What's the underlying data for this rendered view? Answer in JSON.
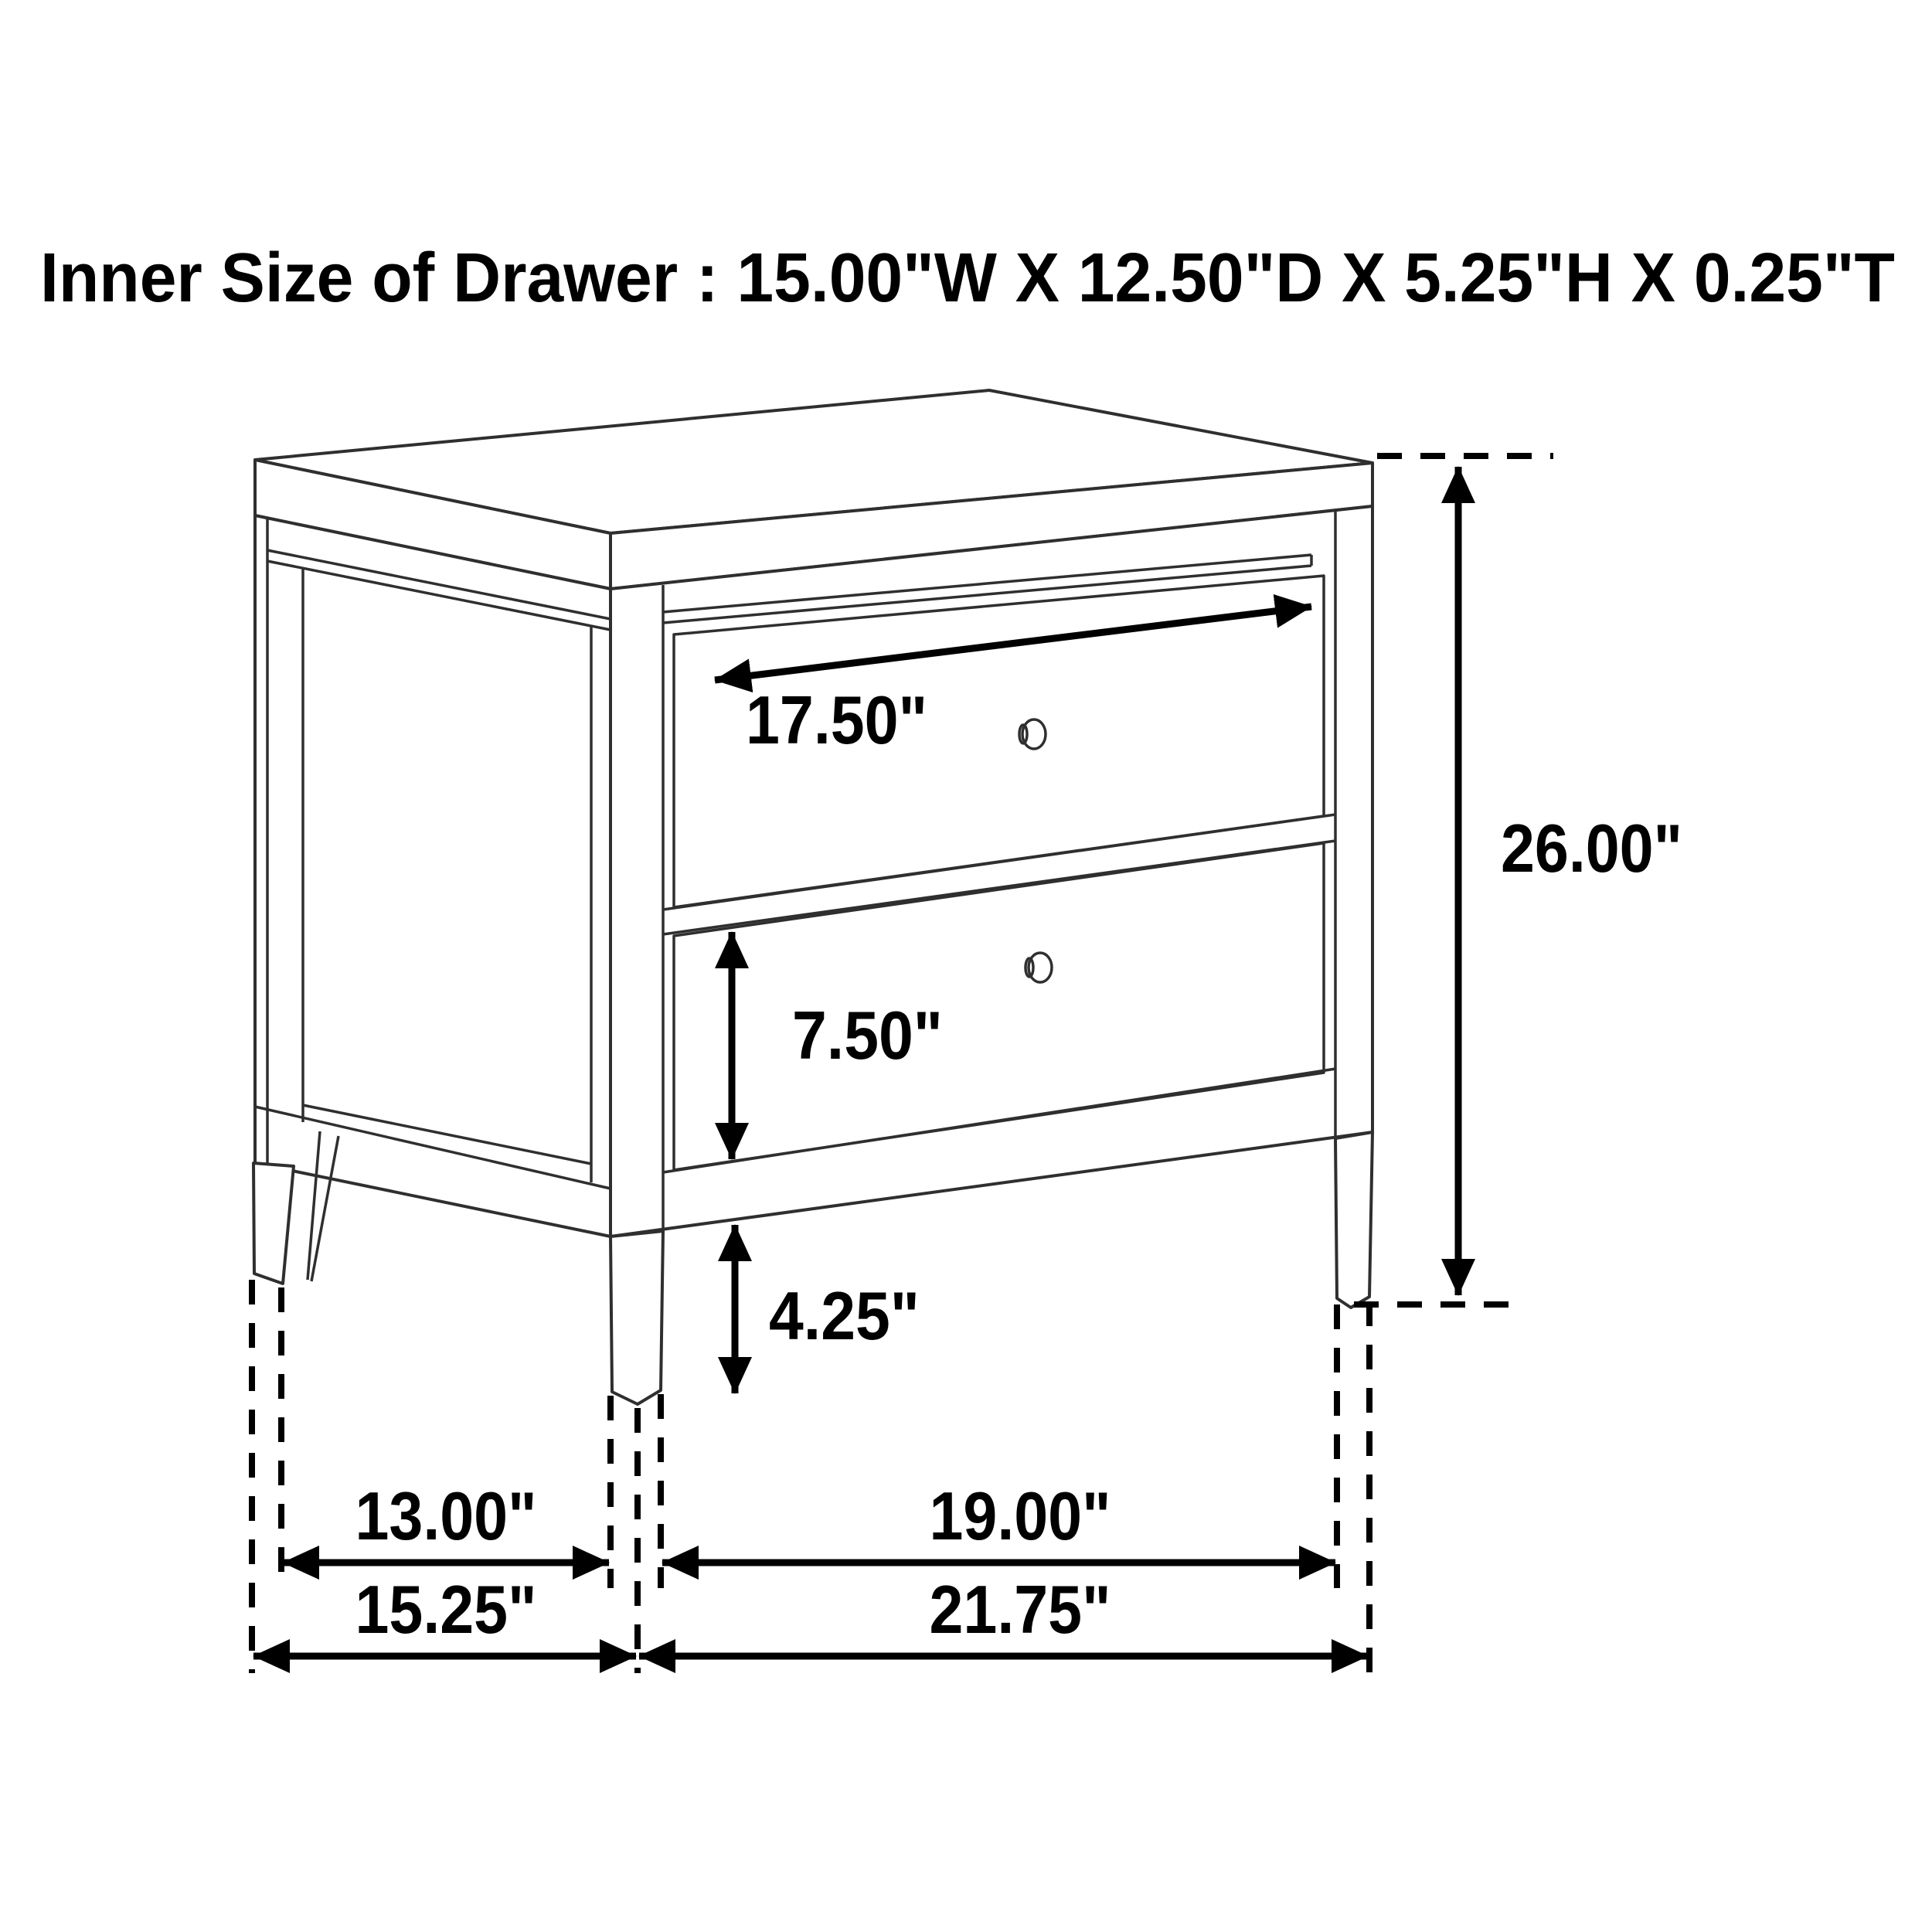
{
  "title": "Inner Size of Drawer : 15.00\"W X 12.50\"D X 5.25\"H X 0.25\"T",
  "inner_drawer_size": {
    "width": "15.00\"W",
    "depth": "12.50\"D",
    "height": "5.25\"H",
    "thickness": "0.25\"T"
  },
  "dimension_labels": {
    "drawer_face_width": "17.50\"",
    "overall_height": "26.00\"",
    "lower_drawer_height": "7.50\"",
    "leg_height": "4.25\"",
    "side_width_inner": "13.00\"",
    "side_width_outer": "15.25\"",
    "front_width_inner": "19.00\"",
    "front_width_outer": "21.75\""
  },
  "drawing": {
    "item": "two-drawer nightstand line drawing",
    "drawer_count": 2,
    "knob_count": 2
  },
  "colors": {
    "background": "#ffffff",
    "outline": "#2f2f2f",
    "dimension": "#000000"
  }
}
